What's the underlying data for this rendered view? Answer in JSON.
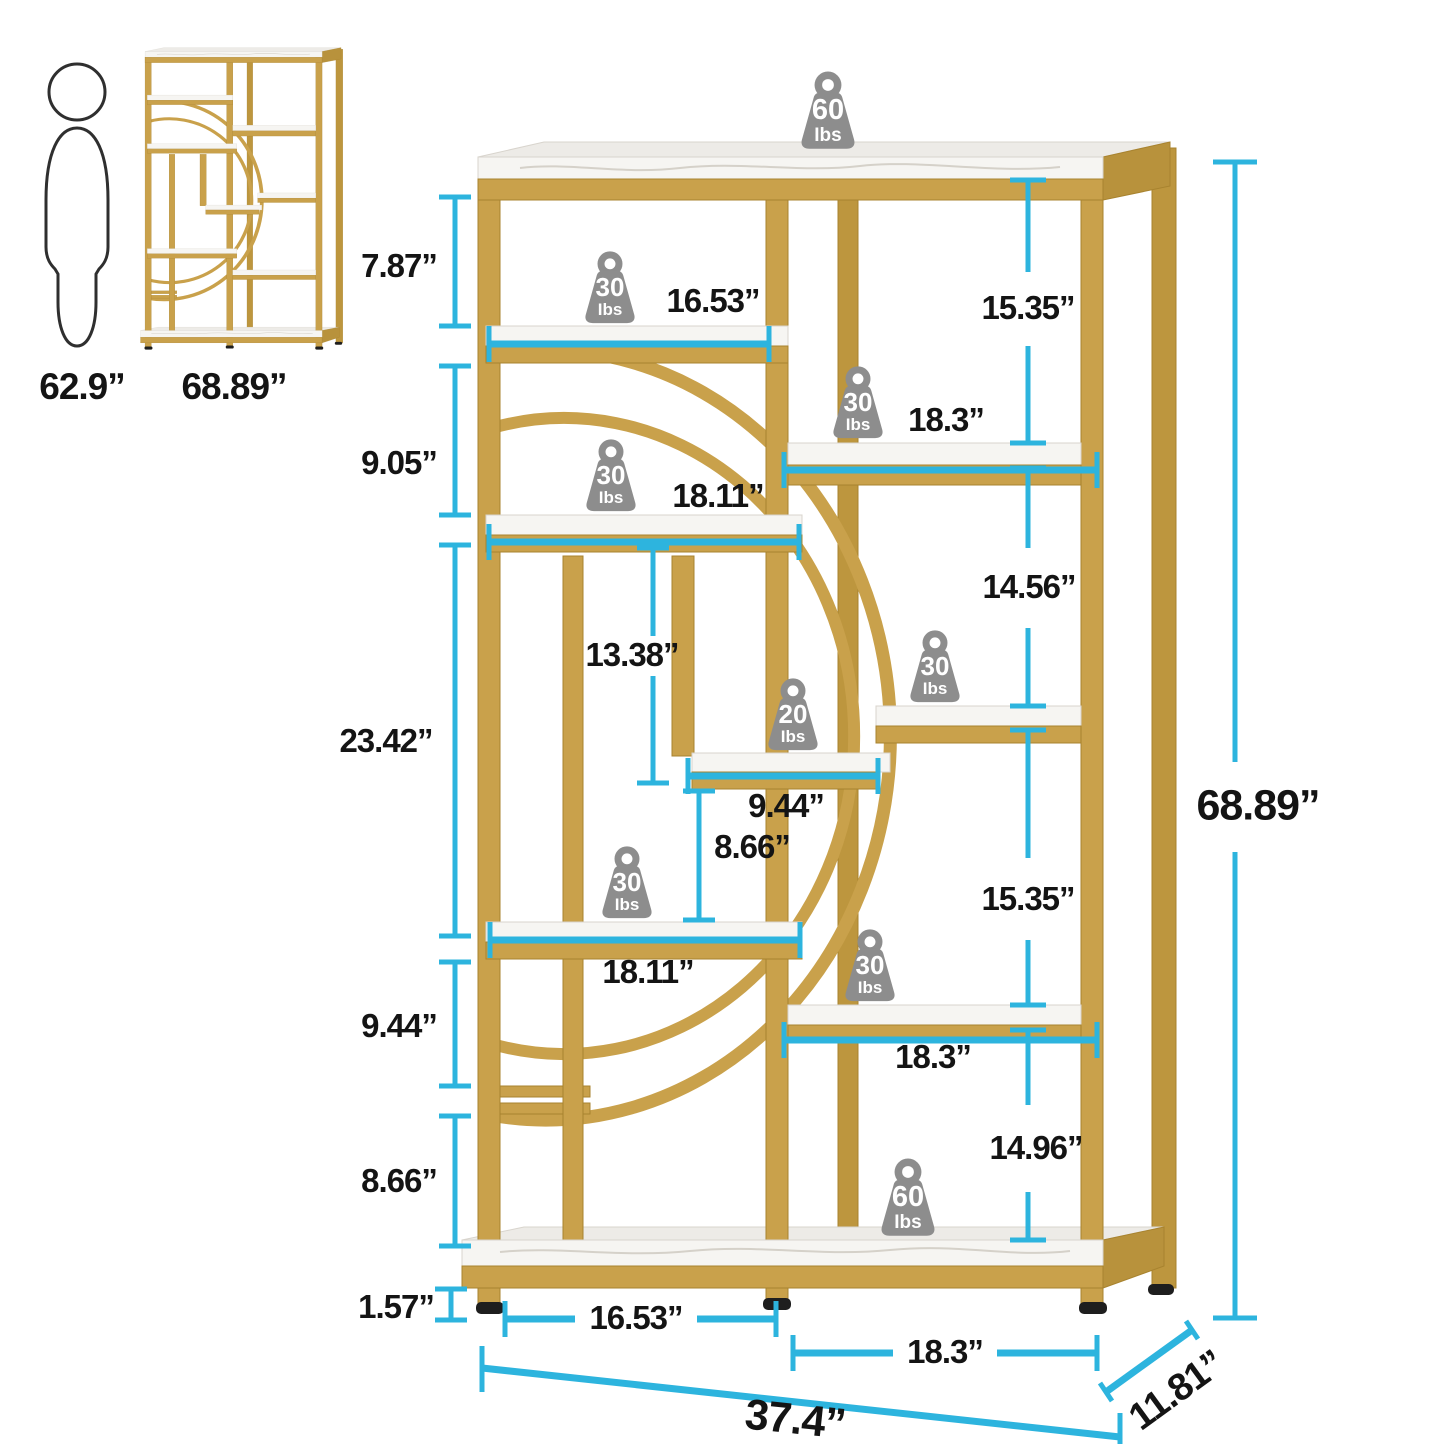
{
  "title": "Bookshelf dimension diagram",
  "colors": {
    "gold": "#c9a14b",
    "gold_dark": "#bd963e",
    "marble": "#f6f5f2",
    "dimension_cyan": "#2db4de",
    "weight_gray": "#8d8d8d",
    "label_text": "#141414"
  },
  "scale_reference": {
    "person_height": "62.9”",
    "unit_height": "68.89”"
  },
  "dims": {
    "left1": "7.87”",
    "left2": "9.05”",
    "left3": "23.42”",
    "left4": "9.44”",
    "left5": "8.66”",
    "left6": "1.57”",
    "right1": "15.35”",
    "right2": "14.56”",
    "right3": "15.35”",
    "right4": "14.96”",
    "mid_upper": "13.38”",
    "mid_lower": "8.66”",
    "shelf_left_1": "16.53”",
    "shelf_right_1": "18.3”",
    "shelf_left_2": "18.11”",
    "shelf_middle": "9.44”",
    "shelf_left_3": "18.11”",
    "shelf_right_3": "18.3”",
    "bottom_left": "16.53”",
    "bottom_right": "18.3”",
    "overall_height": "68.89”",
    "overall_width": "37.4”",
    "overall_depth": "11.81”"
  },
  "weights": [
    {
      "value": "60",
      "unit": "Ibs",
      "location": "top"
    },
    {
      "value": "30",
      "unit": "Ibs",
      "location": "left-shelf-1"
    },
    {
      "value": "30",
      "unit": "Ibs",
      "location": "right-shelf-1"
    },
    {
      "value": "30",
      "unit": "Ibs",
      "location": "left-shelf-2"
    },
    {
      "value": "30",
      "unit": "Ibs",
      "location": "right-shelf-2"
    },
    {
      "value": "20",
      "unit": "Ibs",
      "location": "middle-shelf"
    },
    {
      "value": "30",
      "unit": "Ibs",
      "location": "left-shelf-3"
    },
    {
      "value": "30",
      "unit": "Ibs",
      "location": "right-shelf-3"
    },
    {
      "value": "60",
      "unit": "Ibs",
      "location": "bottom-shelf"
    }
  ]
}
